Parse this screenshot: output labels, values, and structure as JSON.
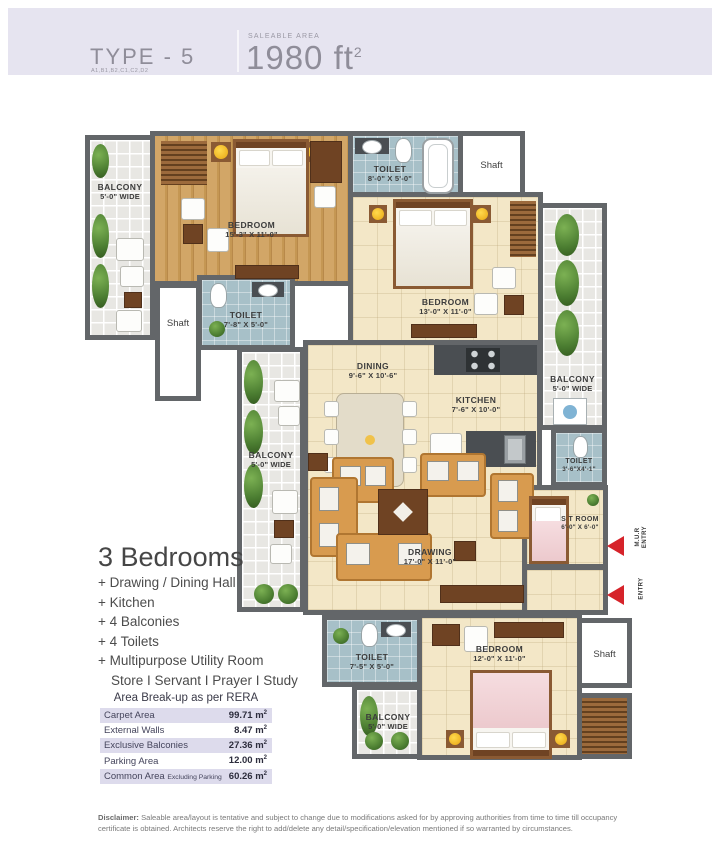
{
  "header": {
    "type_label": "TYPE - 5",
    "type_sub": "A1,B1,B2,C1,C2,D2",
    "saleable_caption": "SALEABLE AREA",
    "saleable_value": "1980 ft",
    "saleable_sup": "2"
  },
  "plan": {
    "rooms": {
      "balcony_tl": {
        "name": "BALCONY",
        "dim": "5'-0\" WIDE"
      },
      "bedroom1": {
        "name": "BEDROOM",
        "dim": "15'-3\" X 11'-0\""
      },
      "toilet_a": {
        "name": "TOILET",
        "dim": "8'-0\" X 5'-0\""
      },
      "shaft_tr": {
        "name": "Shaft"
      },
      "bedroom2": {
        "name": "BEDROOM",
        "dim": "13'-0\" X 11'-0\""
      },
      "balcony_r": {
        "name": "BALCONY",
        "dim": "5'-0\" WIDE"
      },
      "toilet_b": {
        "name": "TOILET",
        "dim": "7'-8\" X 5'-0\""
      },
      "shaft_l": {
        "name": "Shaft"
      },
      "dining": {
        "name": "DINING",
        "dim": "9'-6\" X 10'-6\""
      },
      "kitchen": {
        "name": "KITCHEN",
        "dim": "7'-6\" X 10'-0\""
      },
      "balcony_ml": {
        "name": "BALCONY",
        "dim": "5'-0\" WIDE"
      },
      "toilet_c": {
        "name": "TOILET",
        "dim": "3'-6\"X4'-1\""
      },
      "st_room": {
        "name": "S T ROOM",
        "dim": "6'-0\" X 6'-0\""
      },
      "drawing": {
        "name": "DRAWING",
        "dim": "17'-0\" X 11'-0\""
      },
      "toilet_d": {
        "name": "TOILET",
        "dim": "7'-5\" X 5'-0\""
      },
      "balcony_b": {
        "name": "BALCONY",
        "dim": "5'-0\" WIDE"
      },
      "bedroom3": {
        "name": "BEDROOM",
        "dim": "12'-0\" X 11'-0\""
      },
      "shaft_br": {
        "name": "Shaft"
      }
    },
    "entries": {
      "mur_line1": "M.U.R",
      "mur_line2": "ENTRY",
      "main": "ENTRY"
    }
  },
  "features": {
    "title": "3 Bedrooms",
    "items": [
      "+ Drawing / Dining Hall",
      "+ Kitchen",
      "+ 4 Balconies",
      "+ 4 Toilets",
      "+ Multipurpose Utility Room"
    ],
    "sub_item": "Store I Servant I Prayer I Study"
  },
  "area_table": {
    "title": "Area Break-up as per RERA",
    "unit": "m",
    "sup": "2",
    "rows": [
      {
        "label": "Carpet Area",
        "note": "",
        "value": "99.71"
      },
      {
        "label": "External Walls",
        "note": "",
        "value": "8.47"
      },
      {
        "label": "Exclusive Balconies",
        "note": "",
        "value": "27.36"
      },
      {
        "label": "Parking Area",
        "note": "",
        "value": "12.00"
      },
      {
        "label": "Common Area",
        "note": "Excluding Parking",
        "value": "60.26"
      }
    ]
  },
  "disclaimer": {
    "label": "Disclaimer:",
    "text": "Saleable area/layout is tentative and subject to change due to modifications asked for by approving authorities from time to time till occupancy certificate is obtained. Architects reserve the right to add/delete any detail/specification/elevation mentioned if so warranted by circumstances."
  }
}
